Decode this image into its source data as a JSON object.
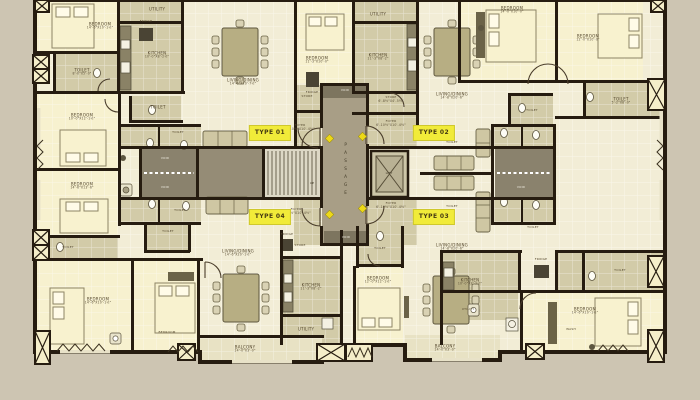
{
  "title": "Apartment typical floor plan",
  "colors": {
    "ground": "#cdc5b2",
    "floor": "#f2edd6",
    "wall": "#261c10",
    "service_room": "#d2cba8",
    "bedroom_tint": "#f7f1cf",
    "core_passage": "#a89e86",
    "void_grey": "#8a826d",
    "balcony": "#e8e2c4",
    "badge_bg": "#f1eb39",
    "entry_diamond": "#edd818"
  },
  "type_labels": [
    {
      "label": "TYPE 01"
    },
    {
      "label": "TYPE 02"
    },
    {
      "label": "TYPE 04"
    },
    {
      "label": "TYPE 03"
    }
  ],
  "core": {
    "passage": "PASSAGE",
    "lift": "LIFT",
    "up": "UP",
    "void_top": "VOID",
    "void_left_a": "VOID",
    "void_left_b": "VOID",
    "void_right": "VOID",
    "void_bottom": "VOID"
  },
  "rooms": {
    "bedroom_tl": {
      "name": "BEDROOM",
      "dims": "14'-6\"X10'-1½\""
    },
    "utility_tl": {
      "name": "UTILITY",
      "dims": "5'-0\"X4'-0\""
    },
    "kitchen_tl": {
      "name": "KITCHEN",
      "dims": "10'-0\"X8'-2½\""
    },
    "toilet_tl": {
      "name": "TOILET",
      "dims": "8'-0\"X5'-0\""
    },
    "toilet_tl2": {
      "name": "TOILET",
      "dims": "5'-2\"X8'-0\""
    },
    "living_tl": {
      "name": "LIVING/DINING",
      "dims": "14'-6\"X20'-7½\""
    },
    "store_tl": {
      "name": "STORE",
      "dims": "6'-8½\"X4'-5½\""
    },
    "foyer_tl": {
      "name": "FOYER",
      "dims": "6'-10½\"X10'-4½\""
    },
    "bedroom_l1": {
      "name": "BEDROOM",
      "dims": "10'-0\"X12'-1½\""
    },
    "bedroom_l2": {
      "name": "BEDROOM",
      "dims": "14'-6\"X13'-6\""
    },
    "bedroom_tc": {
      "name": "BEDROOM",
      "dims": "11'-3\"X10'-0\""
    },
    "toilet_core_tl": {
      "name": "TOILET",
      "dims": "5'-1½\"X3'-1½\""
    },
    "toilet_core_bl": {
      "name": "TOILET",
      "dims": "5'-1½\"X3'-1½\""
    },
    "utility_tr": {
      "name": "UTILITY",
      "dims": "5'-0\"X4'-0\""
    },
    "kitchen_tr": {
      "name": "KITCHEN",
      "dims": "11'-3\"X8'-2\""
    },
    "store_tr": {
      "name": "STORE",
      "dims": "6'-8½\"X4'-5½\""
    },
    "foyer_tr": {
      "name": "FOYER",
      "dims": "6'-10½\"X10'-4½\""
    },
    "living_tr": {
      "name": "LIVING/DINING",
      "dims": "14'-8\"X20'-6\""
    },
    "bedroom_tr1": {
      "name": "BEDROOM",
      "dims": "14'-0\"X10'-0\""
    },
    "bedroom_tr2": {
      "name": "BEDROOM",
      "dims": "12'-0\"X10'-0\""
    },
    "toilet_tr1": {
      "name": "TOILET",
      "dims": "5'-2\"X8'-0\""
    },
    "toilet_tr2": {
      "name": "TOILET",
      "dims": "5'-8\"X8'-0\""
    },
    "toilet_core_tr": {
      "name": "TOILET",
      "dims": "5'-1½\"X3'-1½\""
    },
    "toilet_core_br": {
      "name": "TOILET",
      "dims": "5'-1½\"X3'-1½\""
    },
    "living_bl": {
      "name": "LIVING/DINING",
      "dims": "14'-6\"X20'-1½\""
    },
    "store_bl": {
      "name": "STORE",
      "dims": "6'-8½\"X4'-5½\""
    },
    "foyer_bl": {
      "name": "FOYER",
      "dims": "6'-10½\"X10'-4½\""
    },
    "kitchen_bl": {
      "name": "KITCHEN",
      "dims": "11'-3\"X8'-2\""
    },
    "utility_bl": {
      "name": "UTILITY",
      "dims": "11'-3\"X5'-0\""
    },
    "balcony_bl": {
      "name": "BALCONY",
      "dims": "14'-0\"X3'-0\""
    },
    "bedroom_bl1": {
      "name": "BEDROOM",
      "dims": "14'-6\"X10'-1½\""
    },
    "bedroom_bl2": {
      "name": "BEDROOM",
      "dims": "10'-0\"X12'-1½\""
    },
    "toilet_bl1": {
      "name": "TOILET",
      "dims": "5'-2\"X8'-0\""
    },
    "toilet_bl2": {
      "name": "TOILET",
      "dims": "5'-8\"X8'-0\""
    },
    "foyer_br": {
      "name": "FOYER",
      "dims": "6'-10½\"X10'-4½\""
    },
    "living_br": {
      "name": "LIVING/DINING",
      "dims": "14'-8\"X20'-6\""
    },
    "toilet_br_a": {
      "name": "TOILET",
      "dims": "5'-8\"X8'-0\""
    },
    "toilet_br_b": {
      "name": "TOILET",
      "dims": "5'-8\"X8'-0\""
    },
    "kitchen_br": {
      "name": "KITCHEN",
      "dims": "10'-0\"X8'-2½\""
    },
    "utility_br": {
      "name": "UTILITY",
      "dims": "5'-0\"X4'-0\""
    },
    "balcony_br": {
      "name": "BALCONY",
      "dims": "14'-0\"X3'-0\""
    },
    "bedroom_br1": {
      "name": "BEDROOM",
      "dims": "12'-0\"X12'-1½\""
    },
    "bedroom_br2": {
      "name": "BEDROOM",
      "dims": "14'-6\"X10'-1½\""
    },
    "toilet_br2": {
      "name": "TOILET",
      "dims": "5'-2\"X8'-0\""
    },
    "wash_br": {
      "name": "WASH",
      "dims": ""
    },
    "fridge_a": {
      "name": "FRIDGE",
      "dims": ""
    },
    "fridge_b": {
      "name": "FRIDGE",
      "dims": ""
    },
    "fridge_c": {
      "name": "FRIDGE",
      "dims": ""
    },
    "fridge_d": {
      "name": "FRIDGE",
      "dims": ""
    }
  }
}
